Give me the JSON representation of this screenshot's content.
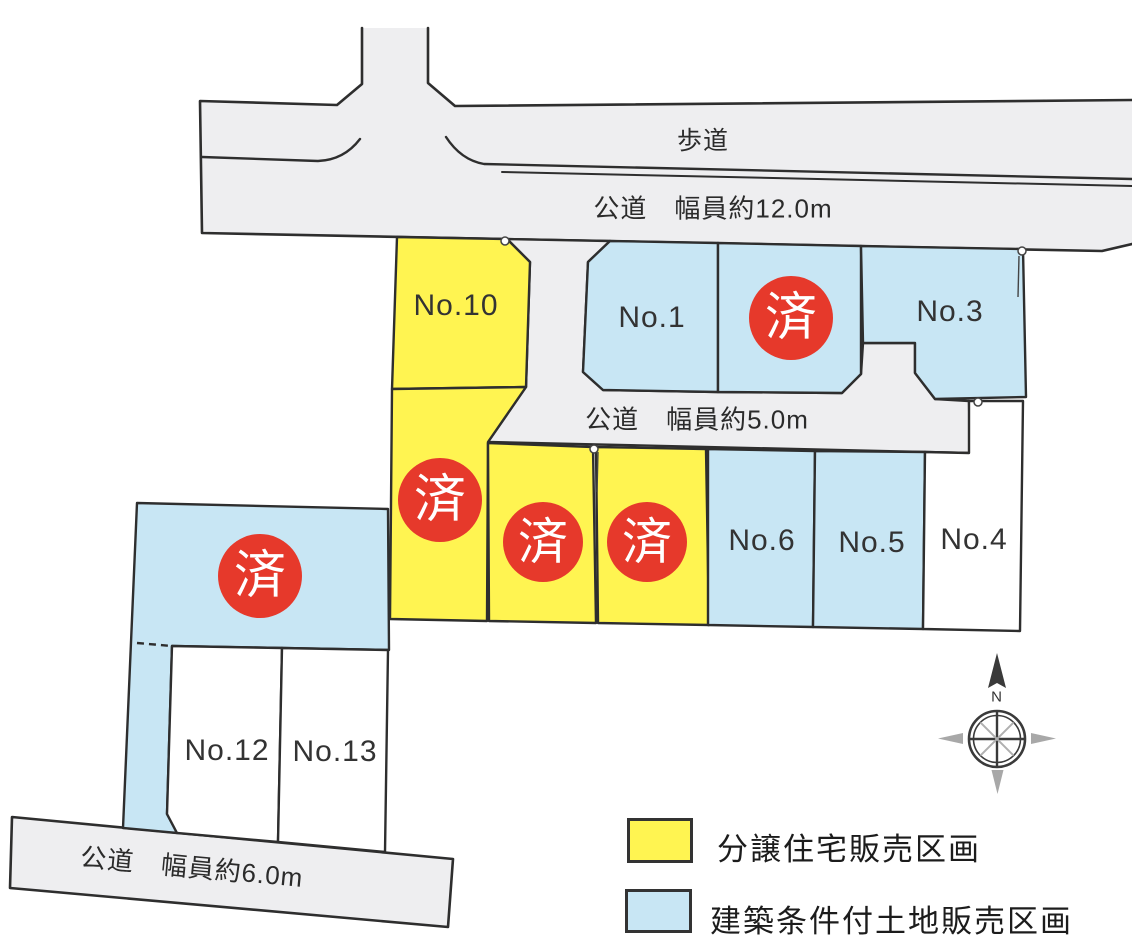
{
  "roads": {
    "sidewalk_label": "歩道",
    "road_12m_label": "公道　幅員約12.0m",
    "road_5m_label": "公道　幅員約5.0m",
    "road_6m_label": "公道　幅員約6.0m"
  },
  "lots": {
    "no1": "No.1",
    "no3": "No.3",
    "no4": "No.4",
    "no5": "No.5",
    "no6": "No.6",
    "no10": "No.10",
    "no12": "No.12",
    "no13": "No.13"
  },
  "sold_mark": "済",
  "compass": {
    "north_label": "N"
  },
  "legend": {
    "items": [
      {
        "label": "分譲住宅販売区画",
        "color": "#FFF451"
      },
      {
        "label": "建築条件付土地販売区画",
        "color": "#C8E6F4"
      }
    ]
  },
  "colors": {
    "house_sale_lot": "#FFF451",
    "conditional_land_lot": "#C8E6F4",
    "road": "#EEEEF0",
    "unassigned_lot": "#FFFFFF",
    "sold_badge": "#E6392B",
    "boundary": "#2E2E2E"
  }
}
